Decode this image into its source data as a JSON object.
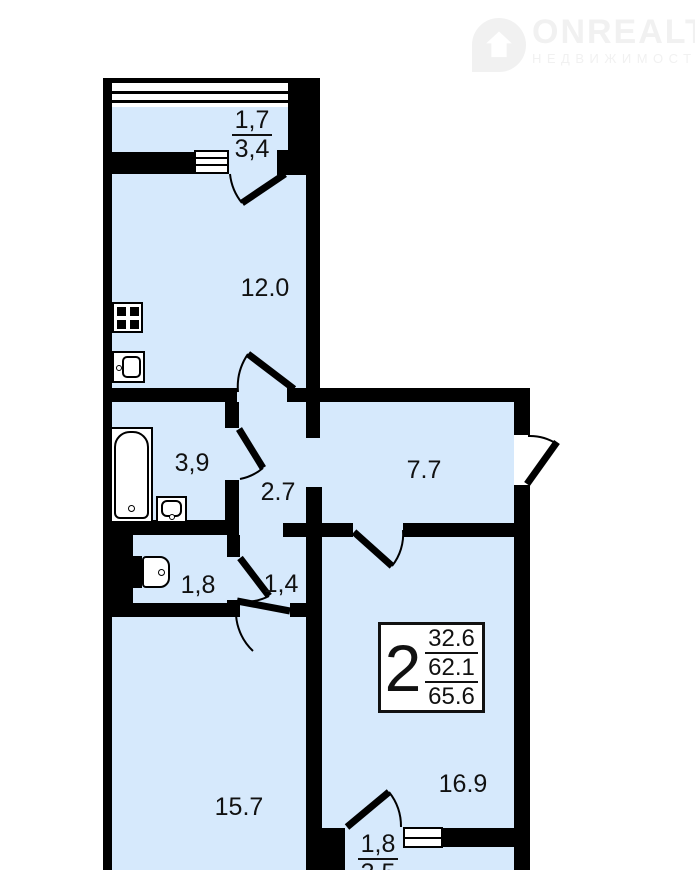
{
  "logo": {
    "brand": "ONREALT",
    "tagline": "НЕДВИЖИМОСТЬ"
  },
  "plan": {
    "rooms": {
      "balcony_top": {
        "area_top": "1,7",
        "area_bottom": "3,4"
      },
      "kitchen": {
        "area": "12.0"
      },
      "bathroom": {
        "area": "3,9"
      },
      "hallway": {
        "area": "2.7"
      },
      "corridor": {
        "area": "7.7"
      },
      "wc": {
        "area": "1,8"
      },
      "hall_small": {
        "area": "1,4"
      },
      "living_room": {
        "area": "15.7"
      },
      "bedroom": {
        "area": "16.9"
      },
      "balcony_bottom": {
        "area_top": "1,8",
        "area_bottom": "3,5"
      }
    },
    "summary": {
      "rooms_count": "2",
      "living_area": "32.6",
      "middle_area": "62.1",
      "total_area": "65.6"
    }
  },
  "colors": {
    "room_fill": "#d6e9fc",
    "wall": "#000000",
    "logo_gray": "#f1f1f1"
  }
}
